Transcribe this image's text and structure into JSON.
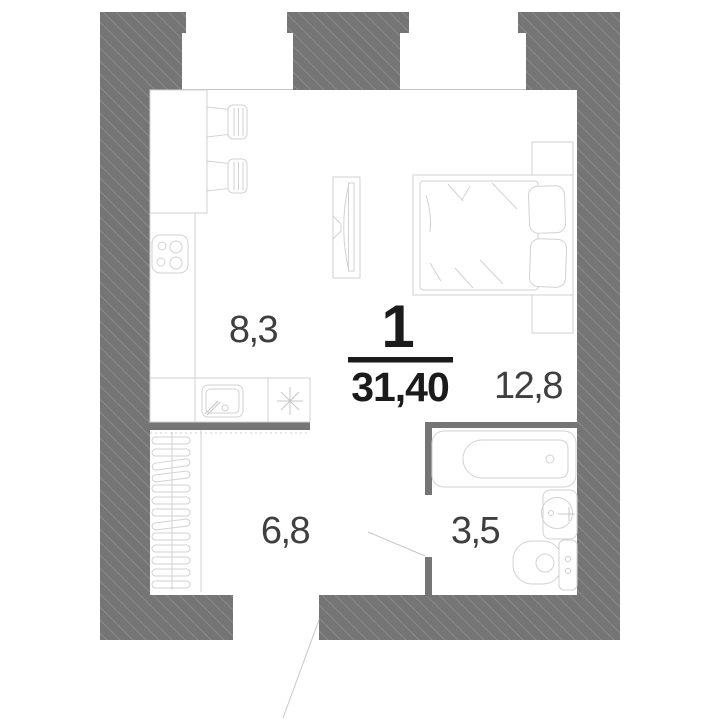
{
  "plan": {
    "kind": "apartment-floor-plan",
    "summary": {
      "rooms_count_label": "1",
      "total_area_label": "31,40"
    },
    "rooms": [
      {
        "id": "kitchen",
        "area_label": "8,3"
      },
      {
        "id": "living-room",
        "area_label": "12,8"
      },
      {
        "id": "hallway",
        "area_label": "6,8"
      },
      {
        "id": "bathroom",
        "area_label": "3,5"
      }
    ],
    "colors": {
      "wall_fill": "#757575",
      "wall_hatch": "#8d8d8d",
      "partition_fill": "#757575",
      "furniture_stroke": "#d2d2d2",
      "room_label_text": "#3f3f3f",
      "summary_text": "#1b1b1b",
      "background": "#ffffff"
    },
    "furniture_icons": [
      "dining-table-icon",
      "chair-icon",
      "stove-icon",
      "kitchen-sink-icon",
      "vent-star-icon",
      "hanger-rack-icon",
      "tv-icon",
      "bed-icon",
      "pillow-icon",
      "wardrobe-icon",
      "bathtub-icon",
      "washbasin-icon",
      "toilet-icon"
    ]
  }
}
